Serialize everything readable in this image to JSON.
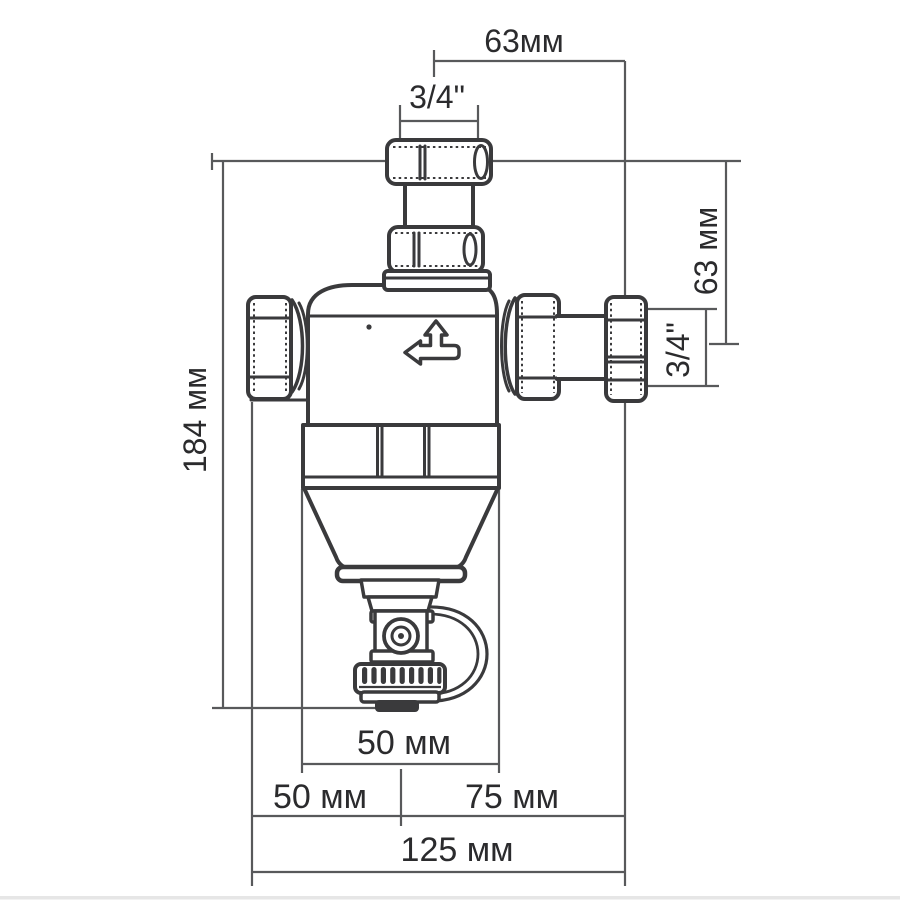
{
  "diagram": {
    "type": "technical-dimension-drawing",
    "subject": "magnetic-filter-dirt-separator-valve",
    "colors": {
      "background": "#ffffff",
      "device_line": "#3a3a3c",
      "dimension_line": "#58595b",
      "text": "#2b2b2d",
      "bottom_strip": "#e6e6e6"
    },
    "dimensions": {
      "top_offset": "63мм",
      "top_thread_size": "3/4\"",
      "right_height": "63 мм",
      "right_thread_size": "3/4\"",
      "overall_height": "184 мм",
      "body_width": "50 мм",
      "bottom_left_offset": "50 мм",
      "bottom_right_offset": "75 мм",
      "overall_width": "125 мм"
    },
    "icons": {
      "flow_direction": "tee-pipe-arrow-left-and-up"
    }
  }
}
